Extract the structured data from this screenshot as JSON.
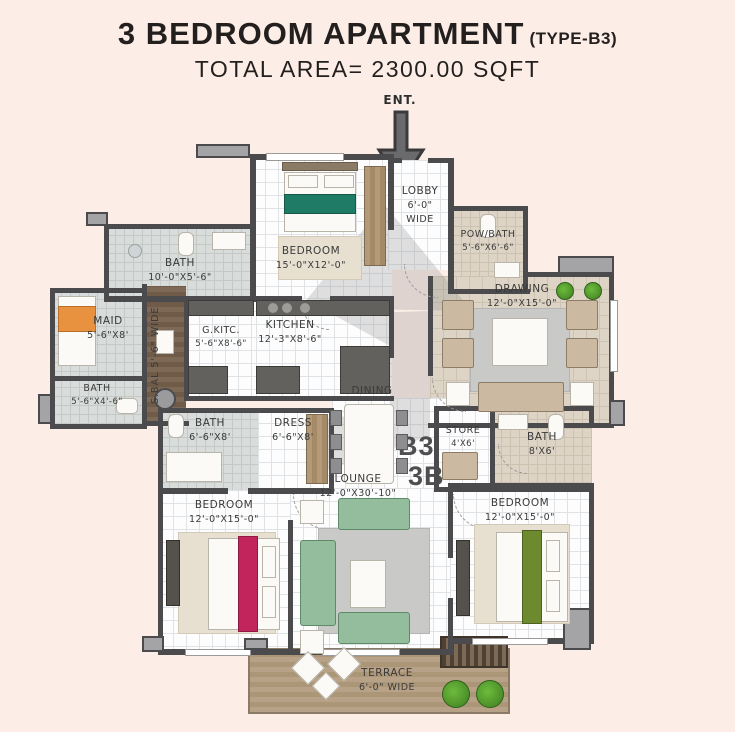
{
  "title": {
    "main": "3 BEDROOM APARTMENT",
    "variant": "(TYPE-B3)",
    "subtitle": "TOTAL AREA= 2300.00 SQFT"
  },
  "entrance_label": "ENT.",
  "watermark": {
    "line1": "B3",
    "line2": "3B"
  },
  "rooms": {
    "bath_top": {
      "name": "BATH",
      "dims": "10'-0\"X5'-6\""
    },
    "bedroom_top": {
      "name": "BEDROOM",
      "dims": "15'-0\"X12'-0\""
    },
    "lobby": {
      "name": "LOBBY",
      "dims": "6'-0\" WIDE"
    },
    "pow_bath": {
      "name": "POW/BATH",
      "dims": "5'-6\"X6'-6\""
    },
    "drawing": {
      "name": "DRAWING",
      "dims": "12'-0\"X15'-0\""
    },
    "maid": {
      "name": "MAID",
      "dims": "5'-6\"X8'"
    },
    "s_bal": {
      "name": "S.BAL",
      "dims": "5'-6\" WIDE"
    },
    "g_kitc": {
      "name": "G.KITC.",
      "dims": "5'-6\"X8'-6\""
    },
    "kitchen": {
      "name": "KITCHEN",
      "dims": "12'-3\"X8'-6\""
    },
    "bath_maid": {
      "name": "BATH",
      "dims": "5'-6\"X4'-6\""
    },
    "bath_left": {
      "name": "BATH",
      "dims": "6'-6\"X8'"
    },
    "dress": {
      "name": "DRESS",
      "dims": "6'-6\"X8'"
    },
    "dining": {
      "name": "DINING",
      "dims": ""
    },
    "store": {
      "name": "STORE",
      "dims": "4'X6'"
    },
    "bath_right": {
      "name": "BATH",
      "dims": "8'X6'"
    },
    "lounge": {
      "name": "LOUNGE",
      "dims": "12'-0\"X30'-10\""
    },
    "bedroom_left": {
      "name": "BEDROOM",
      "dims": "12'-0\"X15'-0\""
    },
    "bedroom_right": {
      "name": "BEDROOM",
      "dims": "12'-0\"X15'-0\""
    },
    "terrace": {
      "name": "TERRACE",
      "dims": "6'-0\" WIDE"
    }
  },
  "colors": {
    "background": "#fceee6",
    "wall": "#4b4b4d",
    "title_text": "#221f1e",
    "sofa_green": "#93bd9c",
    "bed_teal": "#1f7a66",
    "bed_crimson": "#c2255b",
    "bed_olive": "#6d8a2f",
    "maid_orange": "#e8923f",
    "plant_green": "#4ea32e",
    "terrace_wood": "#b8a287"
  }
}
